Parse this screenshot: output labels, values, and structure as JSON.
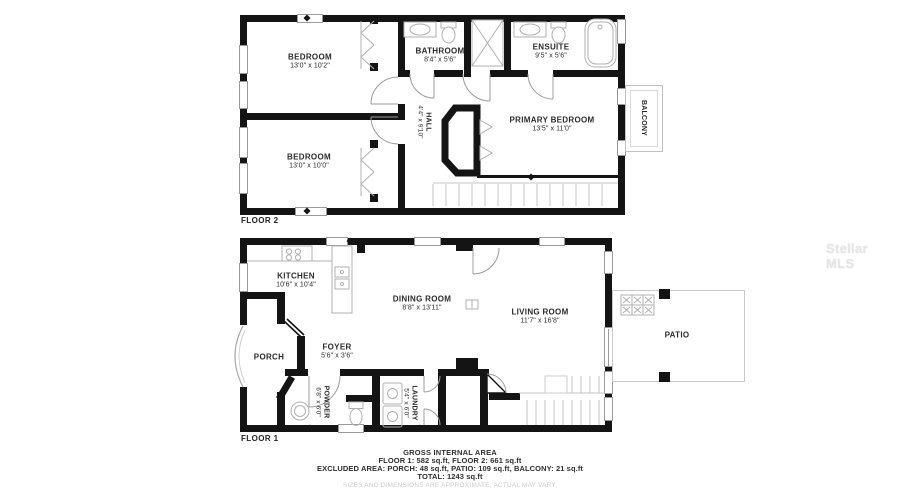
{
  "watermark": "Stellar MLS",
  "colors": {
    "wall": "#141414",
    "fixture_line": "#b0b0b0",
    "label_text": "#2b2b2b",
    "disclaimer_text": "#cbcbcb",
    "watermark_text": "#e6e6e6"
  },
  "floor2": {
    "label": "FLOOR 2",
    "rooms": {
      "bedroom1": {
        "name": "BEDROOM",
        "dims": "13'0\" x 10'2\""
      },
      "bedroom2": {
        "name": "BEDROOM",
        "dims": "13'0\" x 10'0\""
      },
      "bathroom": {
        "name": "BATHROOM",
        "dims": "8'4\" x 5'6\""
      },
      "ensuite": {
        "name": "ENSUITE",
        "dims": "9'5\" x 5'6\""
      },
      "primary": {
        "name": "PRIMARY BEDROOM",
        "dims": "13'5\" x 11'0\""
      },
      "hall": {
        "name": "HALL",
        "dims": "4'4\" x 9'10\""
      },
      "balcony": {
        "name": "BALCONY"
      }
    }
  },
  "floor1": {
    "label": "FLOOR 1",
    "rooms": {
      "kitchen": {
        "name": "KITCHEN",
        "dims": "10'6\" x 10'4\""
      },
      "dining": {
        "name": "DINING ROOM",
        "dims": "8'8\" x 13'11\""
      },
      "living": {
        "name": "LIVING ROOM",
        "dims": "11'7\" x 16'8\""
      },
      "porch": {
        "name": "PORCH"
      },
      "foyer": {
        "name": "FOYER",
        "dims": "5'6\" x 3'6\""
      },
      "powder": {
        "name": "POWDER",
        "dims": "6'8\" x 6'0\""
      },
      "laundry": {
        "name": "LAUNDRY",
        "dims": "5'4\" x 6'0\""
      },
      "patio": {
        "name": "PATIO"
      }
    }
  },
  "summary": {
    "title": "GROSS INTERNAL AREA",
    "line1": "FLOOR 1: 582 sq.ft, FLOOR 2: 661 sq.ft",
    "line2": "EXCLUDED AREA: PORCH: 48 sq.ft, PATIO: 109 sq.ft, BALCONY: 21 sq.ft",
    "line3": "TOTAL: 1243 sq.ft",
    "disclaimer": "SIZES AND DIMENSIONS ARE APPROXIMATE, ACTUAL MAY VARY."
  }
}
